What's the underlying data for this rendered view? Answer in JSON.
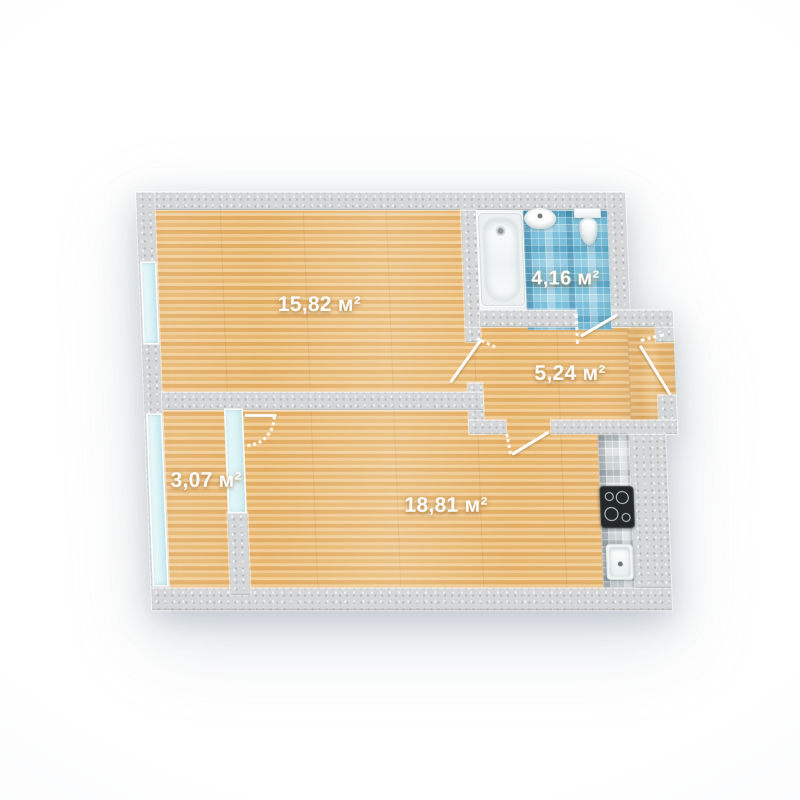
{
  "plan": {
    "area_unit": "м²",
    "rooms": [
      {
        "name": "room-15-82",
        "area_label": "15,82 м²"
      },
      {
        "name": "bathroom",
        "area_label": "4,16 м²"
      },
      {
        "name": "hallway",
        "area_label": "5,24 м²"
      },
      {
        "name": "room-18-81",
        "area_label": "18,81 м²"
      },
      {
        "name": "balcony",
        "area_label": "3,07 м²"
      }
    ],
    "fixtures": [
      {
        "name": "bathtub-icon"
      },
      {
        "name": "washbasin-icon"
      },
      {
        "name": "toilet-icon"
      },
      {
        "name": "cooktop-icon"
      },
      {
        "name": "kitchen-sink-icon"
      }
    ],
    "colors": {
      "wall": "#d5d7d8",
      "wood_floor": "#e9bd7d",
      "bathroom_tile": "#7cc0da",
      "kitchen_tile": "#ced3d4",
      "window_glass": "#dcf2f6",
      "label_text": "#ffffff"
    }
  }
}
